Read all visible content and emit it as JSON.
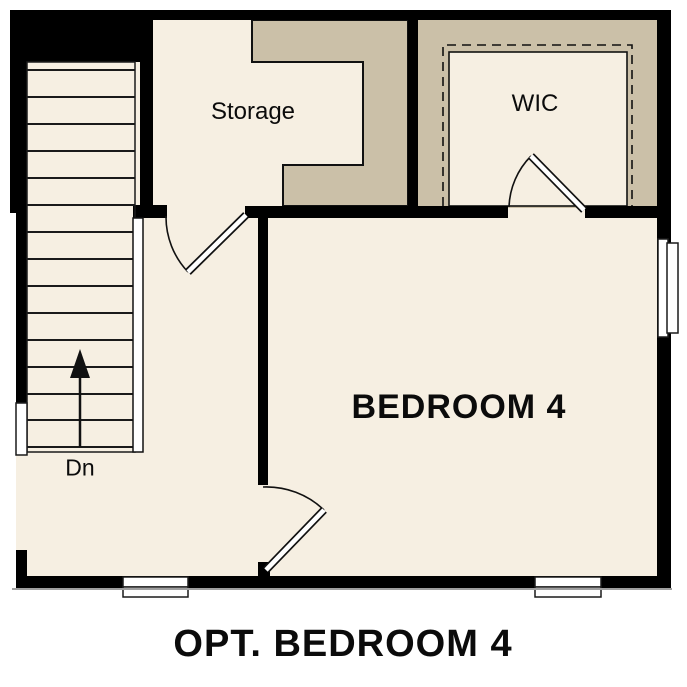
{
  "title": {
    "text": "OPT. BEDROOM 4"
  },
  "rooms": {
    "storage": {
      "label": "Storage"
    },
    "wic": {
      "label": "WIC"
    },
    "bedroom": {
      "label": "BEDROOM 4"
    },
    "stairs": {
      "direction_label": "Dn"
    }
  },
  "colors": {
    "background": "#ffffff",
    "floor": "#f6efe2",
    "shaded": "#cbc0a8",
    "wall": "#000000",
    "window": "#ffffff",
    "shadow": "#a0a0a0",
    "text": "#0b0b0b"
  }
}
